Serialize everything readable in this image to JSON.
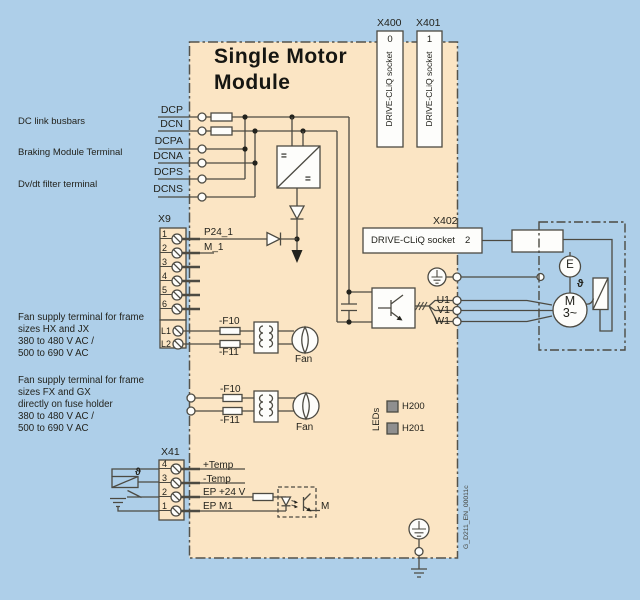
{
  "page": {
    "bg": "#aecfe9",
    "module_bg": "#fbe5c4",
    "line_color": "#4c4a42",
    "led_color": "#8f8f8f"
  },
  "title": {
    "line1": "Single Motor",
    "line2": "Module"
  },
  "left_labels": {
    "dc_link": "DC link busbars",
    "braking": "Braking Module Terminal",
    "dvdt": "Dv/dt filter terminal",
    "fan_hx": [
      "Fan supply terminal for frame",
      "sizes HX and JX",
      "380 to 480 V AC /",
      "500 to 690 V AC"
    ],
    "fan_fx": [
      "Fan supply terminal for frame",
      "sizes FX and GX",
      "directly on fuse holder",
      "380 to 480 V AC /",
      "500 to 690 V AC"
    ]
  },
  "dc_terminals": [
    "DCP",
    "DCN",
    "DCPA",
    "DCNA",
    "DCPS",
    "DCNS"
  ],
  "x9": {
    "label": "X9",
    "pins": [
      "1",
      "2",
      "3",
      "4",
      "5",
      "6"
    ],
    "l1": "L1",
    "l2": "L2",
    "p24": "P24_1",
    "m1": "M_1"
  },
  "x41": {
    "label": "X41",
    "pins": [
      "4",
      "3",
      "2",
      "1"
    ],
    "signals": [
      "+Temp",
      "-Temp",
      "EP +24 V",
      "EP M1"
    ],
    "theta": "ϑ",
    "opto_out": "M"
  },
  "x400": {
    "label": "X400",
    "port": "0",
    "socket": "DRIVE-CLiQ socket"
  },
  "x401": {
    "label": "X401",
    "port": "1",
    "socket": "DRIVE-CLiQ socket"
  },
  "x402": {
    "label": "X402",
    "port": "2",
    "socket": "DRIVE-CLiQ socket"
  },
  "fan_group": {
    "fuse_top": "-F10",
    "fuse_bottom": "-F11",
    "fan": "Fan"
  },
  "leds": {
    "label": "LEDs",
    "led1": "H200",
    "led2": "H201"
  },
  "outputs": [
    "U1",
    "V1",
    "W1"
  ],
  "motor": {
    "encoder": "E",
    "m": "M",
    "phases": "3~",
    "theta": "ϑ"
  },
  "converter": {
    "eq_top": "=",
    "eq_bottom": "="
  },
  "doc_id": "G_D211_EN_00011c"
}
